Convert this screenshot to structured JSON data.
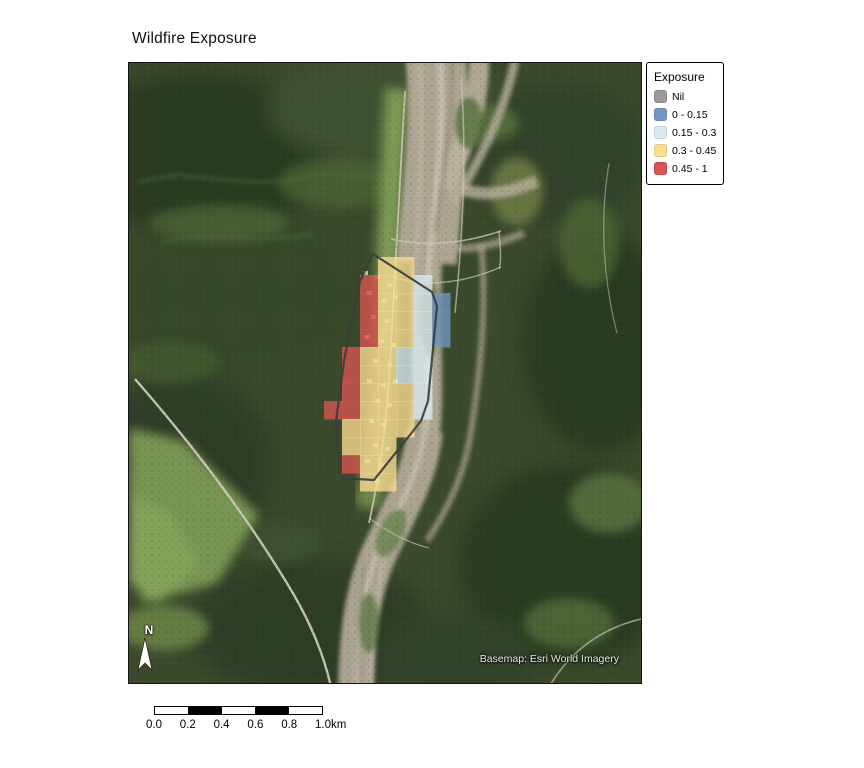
{
  "title": "Wildfire Exposure",
  "map": {
    "attribution": "Basemap: Esri World Imagery",
    "north_label": "N"
  },
  "legend": {
    "title": "Exposure",
    "items": [
      {
        "key": "nil",
        "label": "Nil",
        "color": "#9B9B9B"
      },
      {
        "key": "b",
        "label": "0 - 0.15",
        "color": "#7296C4"
      },
      {
        "key": "lb",
        "label": "0.15 - 0.3",
        "color": "#DBE9F1"
      },
      {
        "key": "y",
        "label": "0.3 - 0.45",
        "color": "#FBDC93"
      },
      {
        "key": "r",
        "label": "0.45 - 1",
        "color": "#D8554F"
      }
    ]
  },
  "scalebar": {
    "tick_labels": [
      "0.0",
      "0.2",
      "0.4",
      "0.6",
      "0.8",
      "1.0"
    ],
    "unit": "km",
    "segment_fills": [
      "#FFFFFF",
      "#000000",
      "#FFFFFF",
      "#000000",
      "#FFFFFF"
    ]
  },
  "map_overlay": {
    "description": "Wildfire exposure classified grid cells drawn over the basemap",
    "grid_origin": [
      195,
      194
    ],
    "cell_size": 18,
    "cell_opacity": 0.78,
    "colors": {
      "r": "#D8554F",
      "y": "#FBDC93",
      "lb": "#DBE9F1",
      "b": "#7296C4",
      "nil": "#9B9B9B"
    },
    "class_labels": {
      "r": "0.45 - 1",
      "y": "0.3 - 0.45",
      "lb": "0.15 - 0.3",
      "b": "0 - 0.15",
      "nil": "Nil"
    },
    "cells": [
      [
        3,
        0,
        "y"
      ],
      [
        4,
        0,
        "y"
      ],
      [
        2,
        1,
        "r"
      ],
      [
        3,
        1,
        "y"
      ],
      [
        4,
        1,
        "y"
      ],
      [
        5,
        1,
        "lb"
      ],
      [
        2,
        2,
        "r"
      ],
      [
        3,
        2,
        "y"
      ],
      [
        4,
        2,
        "y"
      ],
      [
        5,
        2,
        "lb"
      ],
      [
        6,
        2,
        "b"
      ],
      [
        2,
        3,
        "r"
      ],
      [
        3,
        3,
        "y"
      ],
      [
        4,
        3,
        "y"
      ],
      [
        5,
        3,
        "lb"
      ],
      [
        6,
        3,
        "b"
      ],
      [
        2,
        4,
        "r"
      ],
      [
        3,
        4,
        "y"
      ],
      [
        4,
        4,
        "y"
      ],
      [
        5,
        4,
        "lb"
      ],
      [
        6,
        4,
        "b"
      ],
      [
        1,
        5,
        "r"
      ],
      [
        2,
        5,
        "y"
      ],
      [
        3,
        5,
        "y"
      ],
      [
        4,
        5,
        "lb"
      ],
      [
        5,
        5,
        "lb"
      ],
      [
        1,
        6,
        "r"
      ],
      [
        2,
        6,
        "y"
      ],
      [
        3,
        6,
        "y"
      ],
      [
        4,
        6,
        "lb"
      ],
      [
        5,
        6,
        "lb"
      ],
      [
        1,
        7,
        "r"
      ],
      [
        2,
        7,
        "y"
      ],
      [
        3,
        7,
        "y"
      ],
      [
        4,
        7,
        "y"
      ],
      [
        5,
        7,
        "lb"
      ],
      [
        0,
        8,
        "r"
      ],
      [
        1,
        8,
        "r"
      ],
      [
        2,
        8,
        "y"
      ],
      [
        3,
        8,
        "y"
      ],
      [
        4,
        8,
        "y"
      ],
      [
        5,
        8,
        "lb"
      ],
      [
        1,
        9,
        "y"
      ],
      [
        2,
        9,
        "y"
      ],
      [
        3,
        9,
        "y"
      ],
      [
        4,
        9,
        "y"
      ],
      [
        1,
        10,
        "y"
      ],
      [
        2,
        10,
        "y"
      ],
      [
        3,
        10,
        "y"
      ],
      [
        1,
        11,
        "r"
      ],
      [
        2,
        11,
        "y"
      ],
      [
        3,
        11,
        "y"
      ],
      [
        2,
        12,
        "y"
      ],
      [
        3,
        12,
        "y"
      ]
    ],
    "boundary_points": [
      [
        244,
        191
      ],
      [
        303,
        229
      ],
      [
        308,
        243
      ],
      [
        299,
        338
      ],
      [
        292,
        358
      ],
      [
        245,
        417
      ],
      [
        211,
        415
      ],
      [
        207,
        358
      ],
      [
        215,
        298
      ],
      [
        231,
        218
      ]
    ],
    "boundary_color": "#3d3d3d"
  }
}
